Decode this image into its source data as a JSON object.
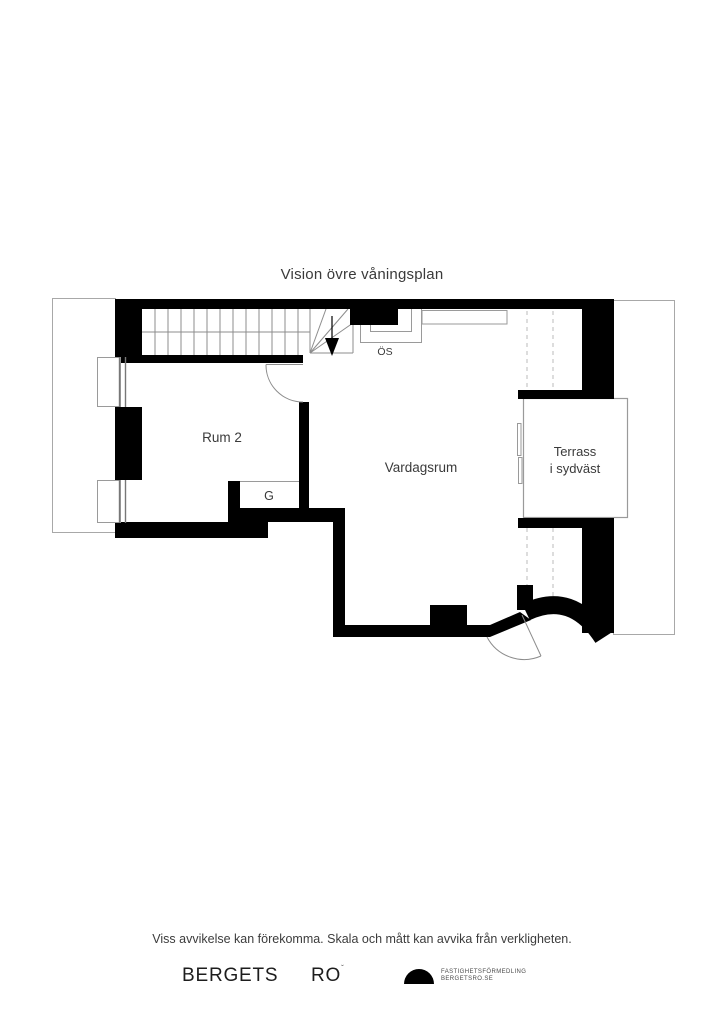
{
  "page": {
    "title": "Vision övre våningsplan"
  },
  "plan": {
    "rooms": {
      "rum2": {
        "label": "Rum 2"
      },
      "vardagsrum": {
        "label": "Vardagsrum"
      },
      "terrass": {
        "label_line1": "Terrass",
        "label_line2": "i sydväst"
      },
      "garderob": {
        "label": "G"
      },
      "oppen_spis": {
        "label": "ÖS"
      }
    }
  },
  "footer": {
    "disclaimer": "Viss avvikelse kan förekomma. Skala och mått kan avvika från verkligheten.",
    "brand": {
      "left": "BERGETS",
      "right": "RO",
      "mark": "ˇ"
    },
    "agency": {
      "line1": "FASTIGHETSFÖRMEDLING",
      "line2": "BERGETSRO.SE",
      "logo_icon": "half-dome-icon"
    }
  },
  "colors": {
    "wall": "#000000",
    "thin_line": "#9a9a9a",
    "dashed_line": "#bbbbbb",
    "text": "#3a3a3a"
  }
}
